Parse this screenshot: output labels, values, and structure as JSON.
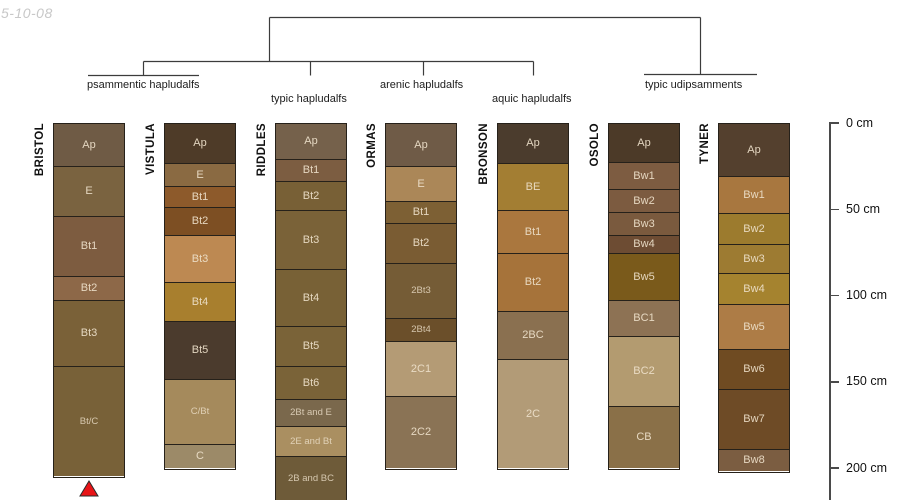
{
  "date_note": "5-10-08",
  "tree": {
    "groups": [
      {
        "label": "psammentic hapludalfs"
      },
      {
        "label": "typic hapludalfs"
      },
      {
        "label": "arenic hapludalfs"
      },
      {
        "label": "aquic hapludalfs"
      },
      {
        "label": "typic udipsamments"
      }
    ]
  },
  "depth_scale": {
    "unit": "cm",
    "tick_labels": [
      "0 cm",
      "50 cm",
      "100 cm",
      "150 cm",
      "200 cm"
    ]
  },
  "marker_color": "#e81417",
  "columns": [
    {
      "name": "BRISTOL",
      "marker": "red-triangle",
      "horizons": [
        {
          "label": "Ap",
          "h": 42,
          "color": "#6f5b45"
        },
        {
          "label": "E",
          "h": 50,
          "color": "#7a6340"
        },
        {
          "label": "Bt1",
          "h": 60,
          "color": "#7d5c40"
        },
        {
          "label": "Bt2",
          "h": 24,
          "color": "#8d6848"
        },
        {
          "label": "Bt3",
          "h": 66,
          "color": "#7a6138"
        },
        {
          "label": "Bt/C",
          "h": 110,
          "color": "#786138"
        }
      ]
    },
    {
      "name": "VISTULA",
      "horizons": [
        {
          "label": "Ap",
          "h": 39,
          "color": "#4e3b28"
        },
        {
          "label": "E",
          "h": 23,
          "color": "#8a6a42"
        },
        {
          "label": "Bt1",
          "h": 21,
          "color": "#8d5a2b"
        },
        {
          "label": "Bt2",
          "h": 28,
          "color": "#7d4f23"
        },
        {
          "label": "Bt3",
          "h": 47,
          "color": "#bd8952"
        },
        {
          "label": "Bt4",
          "h": 39,
          "color": "#a87f2e"
        },
        {
          "label": "Bt5",
          "h": 58,
          "color": "#4b3b2d"
        },
        {
          "label": "C/Bt",
          "h": 65,
          "color": "#a58a5c"
        },
        {
          "label": "C",
          "h": 24,
          "color": "#9c8a68"
        }
      ]
    },
    {
      "name": "RIDDLES",
      "horizons": [
        {
          "label": "Ap",
          "h": 35,
          "color": "#75614b"
        },
        {
          "label": "Bt1",
          "h": 22,
          "color": "#7c5d41"
        },
        {
          "label": "Bt2",
          "h": 29,
          "color": "#786036"
        },
        {
          "label": "Bt3",
          "h": 59,
          "color": "#7a6238"
        },
        {
          "label": "Bt4",
          "h": 57,
          "color": "#786136"
        },
        {
          "label": "Bt5",
          "h": 40,
          "color": "#7a6338"
        },
        {
          "label": "Bt6",
          "h": 33,
          "color": "#7a6338"
        },
        {
          "label": "2Bt and E",
          "h": 27,
          "color": "#7a684c"
        },
        {
          "label": "2E and Bt",
          "h": 30,
          "color": "#aa8f61"
        },
        {
          "label": "2B and BC",
          "h": 45,
          "color": "#6e5b39"
        }
      ]
    },
    {
      "name": "ORMAS",
      "horizons": [
        {
          "label": "Ap",
          "h": 42,
          "color": "#6f5b47"
        },
        {
          "label": "E",
          "h": 35,
          "color": "#ab8758"
        },
        {
          "label": "Bt1",
          "h": 22,
          "color": "#7d6034"
        },
        {
          "label": "Bt2",
          "h": 40,
          "color": "#7a5c33"
        },
        {
          "label": "2Bt3",
          "h": 55,
          "color": "#755c36"
        },
        {
          "label": "2Bt4",
          "h": 23,
          "color": "#6b4f2a"
        },
        {
          "label": "2C1",
          "h": 55,
          "color": "#b49b75"
        },
        {
          "label": "2C2",
          "h": 72,
          "color": "#8a7355"
        }
      ]
    },
    {
      "name": "BRONSON",
      "horizons": [
        {
          "label": "Ap",
          "h": 39,
          "color": "#4b3c2d"
        },
        {
          "label": "BE",
          "h": 47,
          "color": "#a37e33"
        },
        {
          "label": "Bt1",
          "h": 43,
          "color": "#aa773e"
        },
        {
          "label": "Bt2",
          "h": 58,
          "color": "#a6733a"
        },
        {
          "label": "2BC",
          "h": 48,
          "color": "#8a7050"
        },
        {
          "label": "2C",
          "h": 109,
          "color": "#b29b77"
        }
      ]
    },
    {
      "name": "OSOLO",
      "horizons": [
        {
          "label": "Ap",
          "h": 38,
          "color": "#4c3a28"
        },
        {
          "label": "Bw1",
          "h": 27,
          "color": "#7d5c41"
        },
        {
          "label": "Bw2",
          "h": 23,
          "color": "#7c5b40"
        },
        {
          "label": "Bw3",
          "h": 23,
          "color": "#7a5a3e"
        },
        {
          "label": "Bw4",
          "h": 18,
          "color": "#6d4c33"
        },
        {
          "label": "Bw5",
          "h": 47,
          "color": "#7a5a1b"
        },
        {
          "label": "BC1",
          "h": 36,
          "color": "#8d7254"
        },
        {
          "label": "BC2",
          "h": 70,
          "color": "#b39b70"
        },
        {
          "label": "CB",
          "h": 62,
          "color": "#8a7048"
        }
      ]
    },
    {
      "name": "TYNER",
      "horizons": [
        {
          "label": "Ap",
          "h": 52,
          "color": "#54402e"
        },
        {
          "label": "Bw1",
          "h": 37,
          "color": "#a8773f"
        },
        {
          "label": "Bw2",
          "h": 31,
          "color": "#9c7b2e"
        },
        {
          "label": "Bw3",
          "h": 29,
          "color": "#9d7b32"
        },
        {
          "label": "Bw4",
          "h": 31,
          "color": "#a5832f"
        },
        {
          "label": "Bw5",
          "h": 45,
          "color": "#ad7c46"
        },
        {
          "label": "Bw6",
          "h": 40,
          "color": "#6f4b22"
        },
        {
          "label": "Bw7",
          "h": 60,
          "color": "#6e4b26"
        },
        {
          "label": "Bw8",
          "h": 22,
          "color": "#7b5d41"
        }
      ]
    }
  ]
}
